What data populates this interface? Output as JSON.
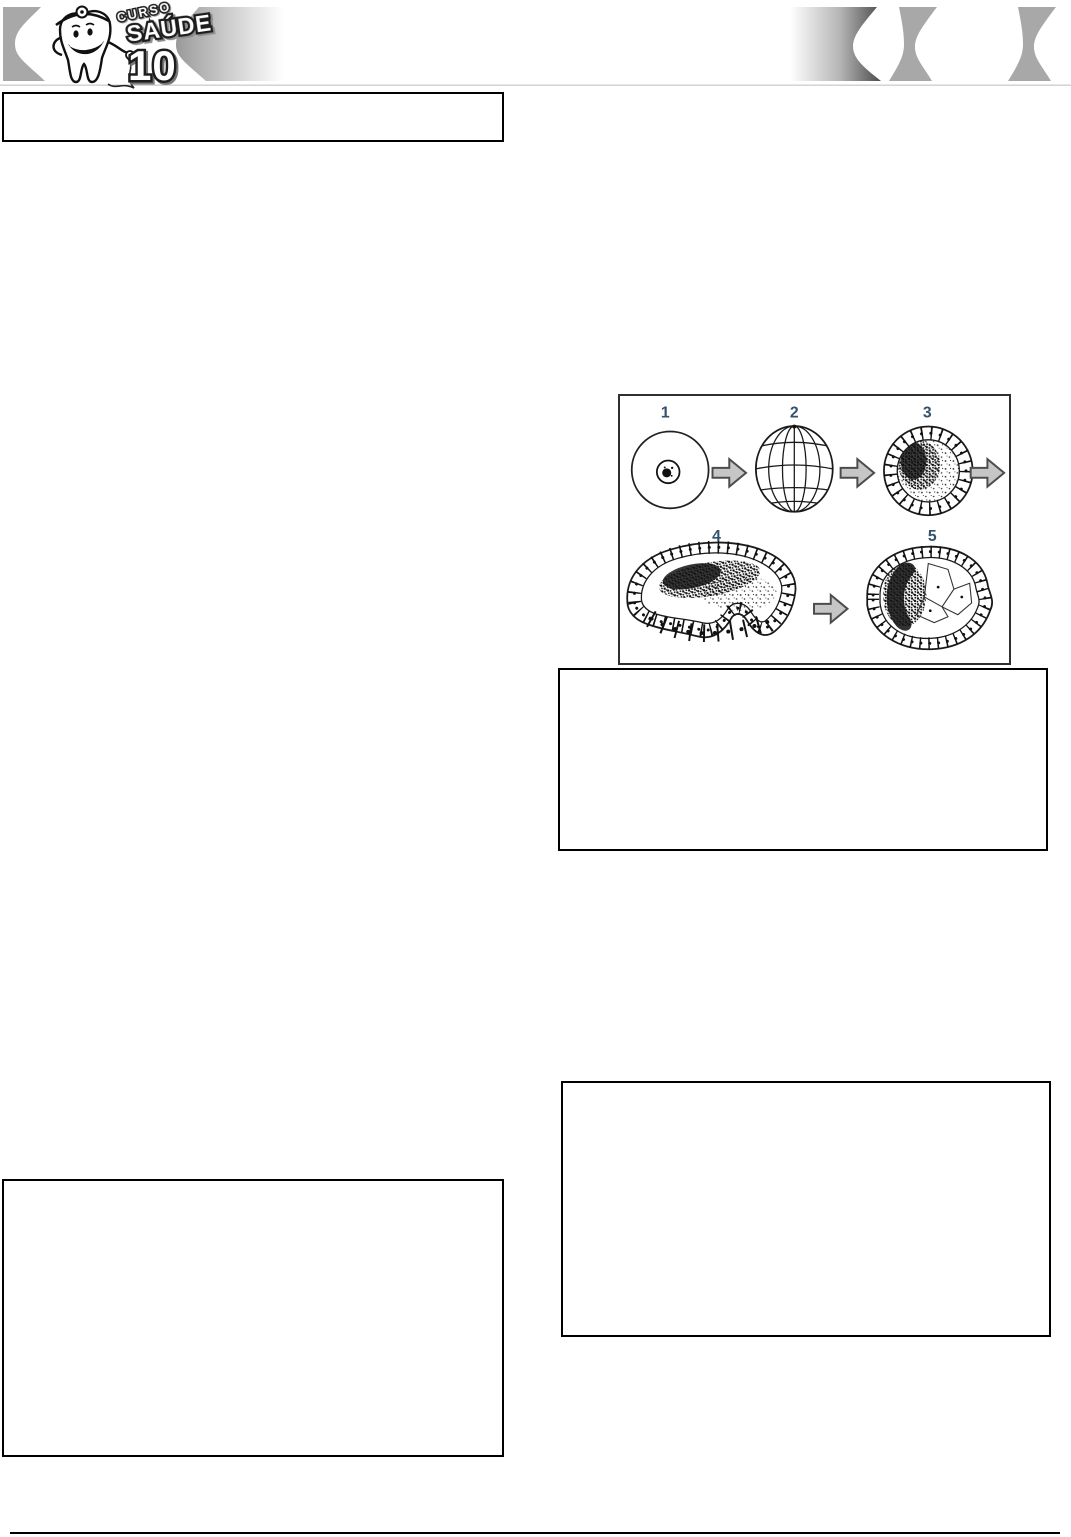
{
  "page": {
    "background_color": "#ffffff"
  },
  "header": {
    "logo": {
      "text_top": "CURSO",
      "text_main": "SAÚDE",
      "text_number": "10"
    },
    "ribbon_color": "#a8a8a8",
    "gradient_dark_color": "#4c4c4c",
    "divider_color": "#cfcfcf"
  },
  "figure": {
    "stage_labels": [
      "1",
      "2",
      "3",
      "4",
      "5"
    ],
    "label_color": "#33516b",
    "arrow_fill_color": "#c6c6c6",
    "arrow_stroke_color": "#4c4c4c",
    "border_color": "#2f2f2f"
  },
  "footer": {
    "rule_color": "#000000"
  }
}
